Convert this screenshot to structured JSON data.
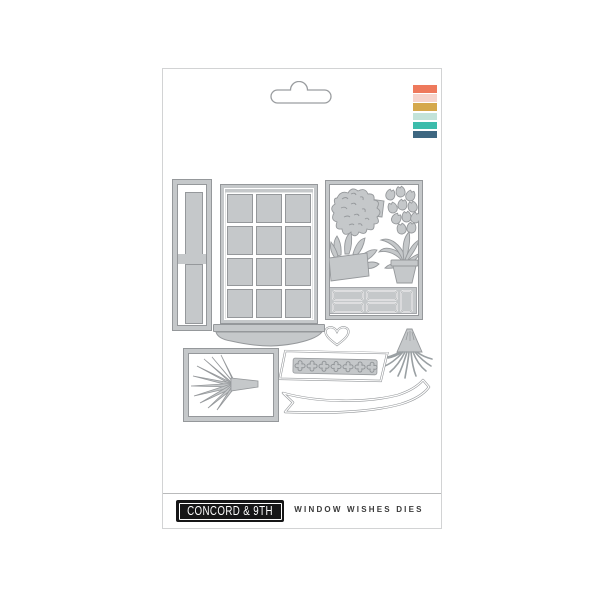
{
  "package": {
    "brand_logo": "CONCORD & 9TH",
    "product_title": "WINDOW WISHES DIES",
    "stripes": [
      "#ee795c",
      "#f6d4cc",
      "#d5a84b",
      "#c3e3d9",
      "#3cbcab",
      "#3e6781"
    ],
    "die_fill_color": "#c5c8ca",
    "die_outline_color": "#95989b",
    "dies": [
      "side-trim-die",
      "window-grid-die",
      "window-sill-die",
      "plants-panel-die",
      "heart-die",
      "hanging-plant-die",
      "framed-plant-die",
      "flower-box-die",
      "banner-die"
    ]
  }
}
